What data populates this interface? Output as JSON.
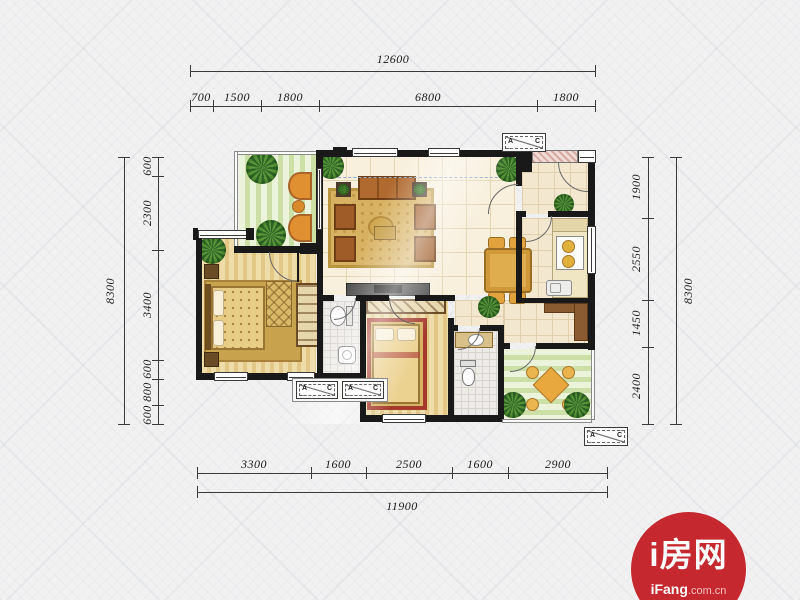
{
  "dimensions": {
    "top": {
      "total": "12600",
      "segments": [
        "700",
        "1500",
        "1800",
        "6800",
        "1800"
      ]
    },
    "bottom": {
      "total": "11900",
      "segments": [
        "3300",
        "1600",
        "2500",
        "1600",
        "2900"
      ]
    },
    "left": {
      "total": "8300",
      "segments": [
        "600",
        "2300",
        "3400",
        "600",
        "800",
        "600"
      ]
    },
    "right": {
      "total": "8300",
      "segments": [
        "1900",
        "2550",
        "1450",
        "2400"
      ]
    }
  },
  "ac_unit": {
    "left_letter": "A",
    "right_letter": "C"
  },
  "logo": {
    "title": "i房网",
    "brand": "iFang",
    "suffix": ".com.cn",
    "color": "#c5282e"
  }
}
